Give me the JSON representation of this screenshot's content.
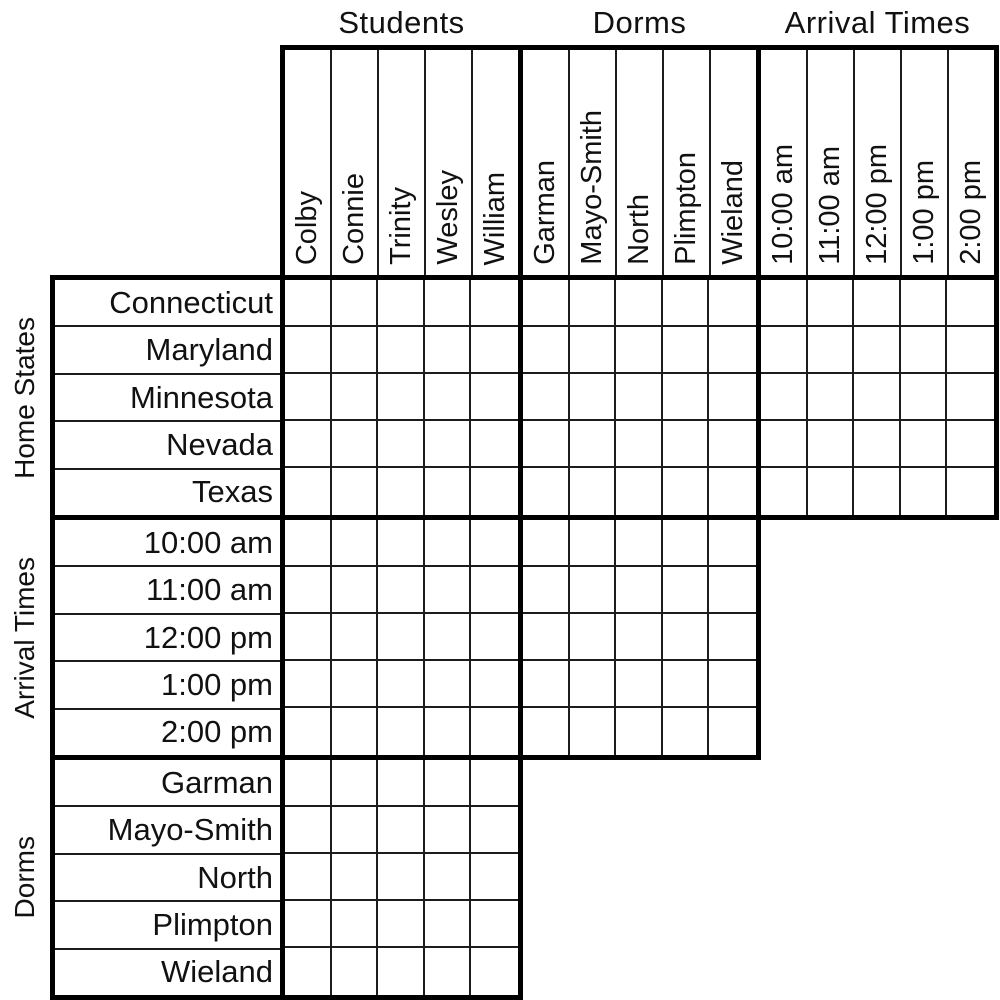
{
  "puzzle": {
    "column_groups": [
      {
        "label": "Students",
        "items": [
          "Colby",
          "Connie",
          "Trinity",
          "Wesley",
          "William"
        ]
      },
      {
        "label": "Dorms",
        "items": [
          "Garman",
          "Mayo-Smith",
          "North",
          "Plimpton",
          "Wieland"
        ]
      },
      {
        "label": "Arrival Times",
        "items": [
          "10:00 am",
          "11:00 am",
          "12:00 pm",
          "1:00 pm",
          "2:00 pm"
        ]
      }
    ],
    "row_groups": [
      {
        "label": "Home States",
        "items": [
          "Connecticut",
          "Maryland",
          "Minnesota",
          "Nevada",
          "Texas"
        ]
      },
      {
        "label": "Arrival Times",
        "items": [
          "10:00 am",
          "11:00 am",
          "12:00 pm",
          "1:00 pm",
          "2:00 pm"
        ]
      },
      {
        "label": "Dorms",
        "items": [
          "Garman",
          "Mayo-Smith",
          "North",
          "Plimpton",
          "Wieland"
        ]
      }
    ],
    "grid_blocks": [
      {
        "row_group": "Home States",
        "col_group": "Students",
        "rows": 5,
        "cols": 5,
        "marks": []
      },
      {
        "row_group": "Home States",
        "col_group": "Dorms",
        "rows": 5,
        "cols": 5,
        "marks": []
      },
      {
        "row_group": "Home States",
        "col_group": "Arrival Times",
        "rows": 5,
        "cols": 5,
        "marks": []
      },
      {
        "row_group": "Arrival Times",
        "col_group": "Students",
        "rows": 5,
        "cols": 5,
        "marks": []
      },
      {
        "row_group": "Arrival Times",
        "col_group": "Dorms",
        "rows": 5,
        "cols": 5,
        "marks": []
      },
      {
        "row_group": "Dorms",
        "col_group": "Students",
        "rows": 5,
        "cols": 5,
        "marks": []
      }
    ],
    "colors": {
      "grid_line": "#000000",
      "thin_line": "#1c1c1c",
      "background": "#ffffff",
      "text": "#111111"
    }
  }
}
